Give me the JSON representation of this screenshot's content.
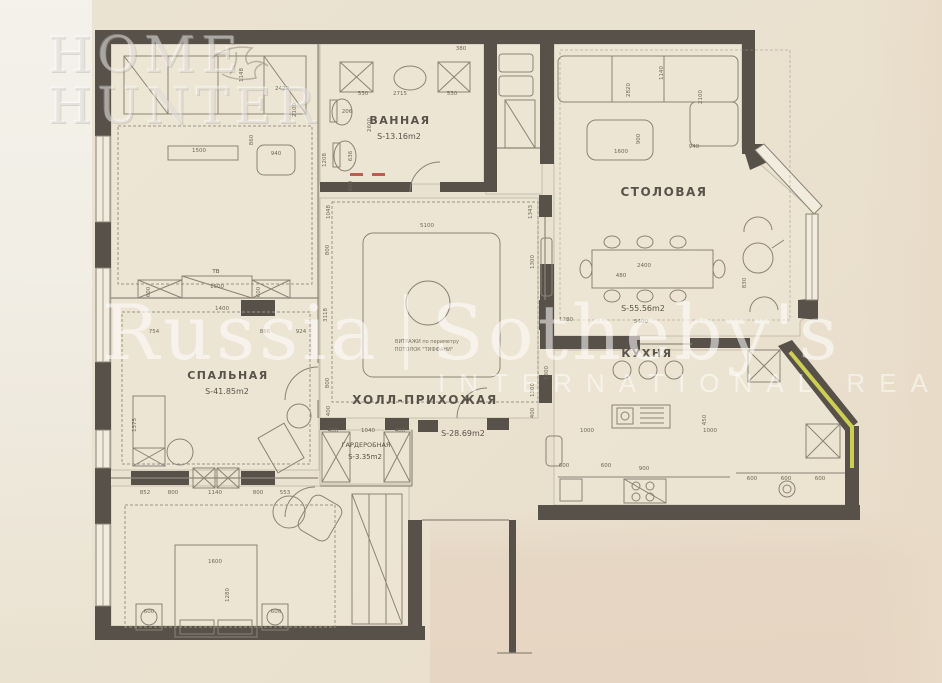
{
  "watermarks": {
    "home_hunter_line1": "HOME",
    "home_hunter_line2": "HUNTER",
    "brand_left": "Russia",
    "brand_right": "Sotheby's",
    "brand_sub": "INTERNATIONAL REALTY"
  },
  "rooms": {
    "bathroom": {
      "name": "ВАННАЯ",
      "area": "S-13.16m2"
    },
    "dining": {
      "name": "СТОЛОВАЯ",
      "area": "S-55.56m2"
    },
    "kitchen": {
      "name": "КУХНЯ"
    },
    "bedroom": {
      "name": "СПАЛЬНАЯ",
      "area": "S-41.85m2"
    },
    "hall": {
      "name": "ХОЛЛ-ПРИХОЖАЯ",
      "area": "S-28.69m2"
    },
    "wardrobe": {
      "name": "ГАРДЕРОБНАЯ",
      "area": "S-3.35m2"
    },
    "hall_note_line1": "ВИТРАЖИ по периметру",
    "hall_note_line2": "ПОТОЛОК \"ТИФФАНИ\"",
    "tv_label": "ТВ"
  },
  "colors": {
    "paper": "#eae1cf",
    "wall": "#57514a",
    "line": "#8b8276",
    "highlight_wall": "#d9dd55",
    "red_mark": "#b5443c",
    "watermark": "rgba(255,255,255,0.55)"
  },
  "plan": {
    "dimensions": [
      {
        "t": "530",
        "x": 363,
        "y": 95
      },
      {
        "t": "2715",
        "x": 400,
        "y": 95
      },
      {
        "t": "530",
        "x": 452,
        "y": 95
      },
      {
        "t": "206",
        "x": 347,
        "y": 113
      },
      {
        "t": "2600",
        "x": 371,
        "y": 125,
        "r": -90
      },
      {
        "t": "636",
        "x": 352,
        "y": 156,
        "r": -90
      },
      {
        "t": "600",
        "x": 352,
        "y": 186,
        "r": -90
      },
      {
        "t": "1208",
        "x": 326,
        "y": 160,
        "r": -90
      },
      {
        "t": "380",
        "x": 461,
        "y": 50
      },
      {
        "t": "1148",
        "x": 243,
        "y": 75,
        "r": -90
      },
      {
        "t": "2420",
        "x": 282,
        "y": 90
      },
      {
        "t": "2100",
        "x": 296,
        "y": 110,
        "r": -90
      },
      {
        "t": "1500",
        "x": 199,
        "y": 152
      },
      {
        "t": "940",
        "x": 276,
        "y": 155
      },
      {
        "t": "860",
        "x": 253,
        "y": 140,
        "r": -90
      },
      {
        "t": "2820",
        "x": 630,
        "y": 90,
        "r": -90
      },
      {
        "t": "1140",
        "x": 663,
        "y": 73,
        "r": -90
      },
      {
        "t": "2100",
        "x": 702,
        "y": 97,
        "r": -90
      },
      {
        "t": "1600",
        "x": 621,
        "y": 153
      },
      {
        "t": "900",
        "x": 640,
        "y": 139,
        "r": -90
      },
      {
        "t": "940",
        "x": 694,
        "y": 148
      },
      {
        "t": "2400",
        "x": 644,
        "y": 267
      },
      {
        "t": "480",
        "x": 621,
        "y": 277
      },
      {
        "t": "1280",
        "x": 566,
        "y": 321
      },
      {
        "t": "5400",
        "x": 641,
        "y": 323
      },
      {
        "t": "830",
        "x": 746,
        "y": 283,
        "r": -90
      },
      {
        "t": "1300",
        "x": 548,
        "y": 373,
        "r": -90
      },
      {
        "t": "1000",
        "x": 587,
        "y": 432
      },
      {
        "t": "1000",
        "x": 710,
        "y": 432
      },
      {
        "t": "450",
        "x": 706,
        "y": 420,
        "r": -90
      },
      {
        "t": "600",
        "x": 564,
        "y": 467
      },
      {
        "t": "600",
        "x": 606,
        "y": 467
      },
      {
        "t": "900",
        "x": 644,
        "y": 470
      },
      {
        "t": "600",
        "x": 752,
        "y": 480
      },
      {
        "t": "600",
        "x": 786,
        "y": 480
      },
      {
        "t": "600",
        "x": 820,
        "y": 480
      },
      {
        "t": "1048",
        "x": 330,
        "y": 212,
        "r": -90
      },
      {
        "t": "5100",
        "x": 427,
        "y": 227
      },
      {
        "t": "1343",
        "x": 532,
        "y": 212,
        "r": -90
      },
      {
        "t": "800",
        "x": 329,
        "y": 250,
        "r": -90
      },
      {
        "t": "3118",
        "x": 327,
        "y": 315,
        "r": -90
      },
      {
        "t": "1300",
        "x": 534,
        "y": 262,
        "r": -90
      },
      {
        "t": "1300",
        "x": 534,
        "y": 390,
        "r": -90
      },
      {
        "t": "800",
        "x": 329,
        "y": 383,
        "r": -90
      },
      {
        "t": "400",
        "x": 330,
        "y": 411,
        "r": -90
      },
      {
        "t": "400",
        "x": 534,
        "y": 413,
        "r": -90
      },
      {
        "t": "400",
        "x": 333,
        "y": 432
      },
      {
        "t": "1040",
        "x": 368,
        "y": 432
      },
      {
        "t": "400",
        "x": 400,
        "y": 432
      },
      {
        "t": "1400",
        "x": 222,
        "y": 310
      },
      {
        "t": "754",
        "x": 154,
        "y": 333
      },
      {
        "t": "866",
        "x": 265,
        "y": 333
      },
      {
        "t": "924",
        "x": 301,
        "y": 333
      },
      {
        "t": "1500",
        "x": 217,
        "y": 288
      },
      {
        "t": "600",
        "x": 150,
        "y": 292,
        "r": -90
      },
      {
        "t": "600",
        "x": 260,
        "y": 292,
        "r": -90
      },
      {
        "t": "1375",
        "x": 136,
        "y": 425,
        "r": -90
      },
      {
        "t": "852",
        "x": 145,
        "y": 494
      },
      {
        "t": "800",
        "x": 173,
        "y": 494
      },
      {
        "t": "1140",
        "x": 215,
        "y": 494
      },
      {
        "t": "800",
        "x": 258,
        "y": 494
      },
      {
        "t": "553",
        "x": 285,
        "y": 494
      },
      {
        "t": "1600",
        "x": 215,
        "y": 563
      },
      {
        "t": "1280",
        "x": 229,
        "y": 595,
        "r": -90
      },
      {
        "t": "600",
        "x": 149,
        "y": 613
      },
      {
        "t": "600",
        "x": 276,
        "y": 613
      }
    ]
  }
}
